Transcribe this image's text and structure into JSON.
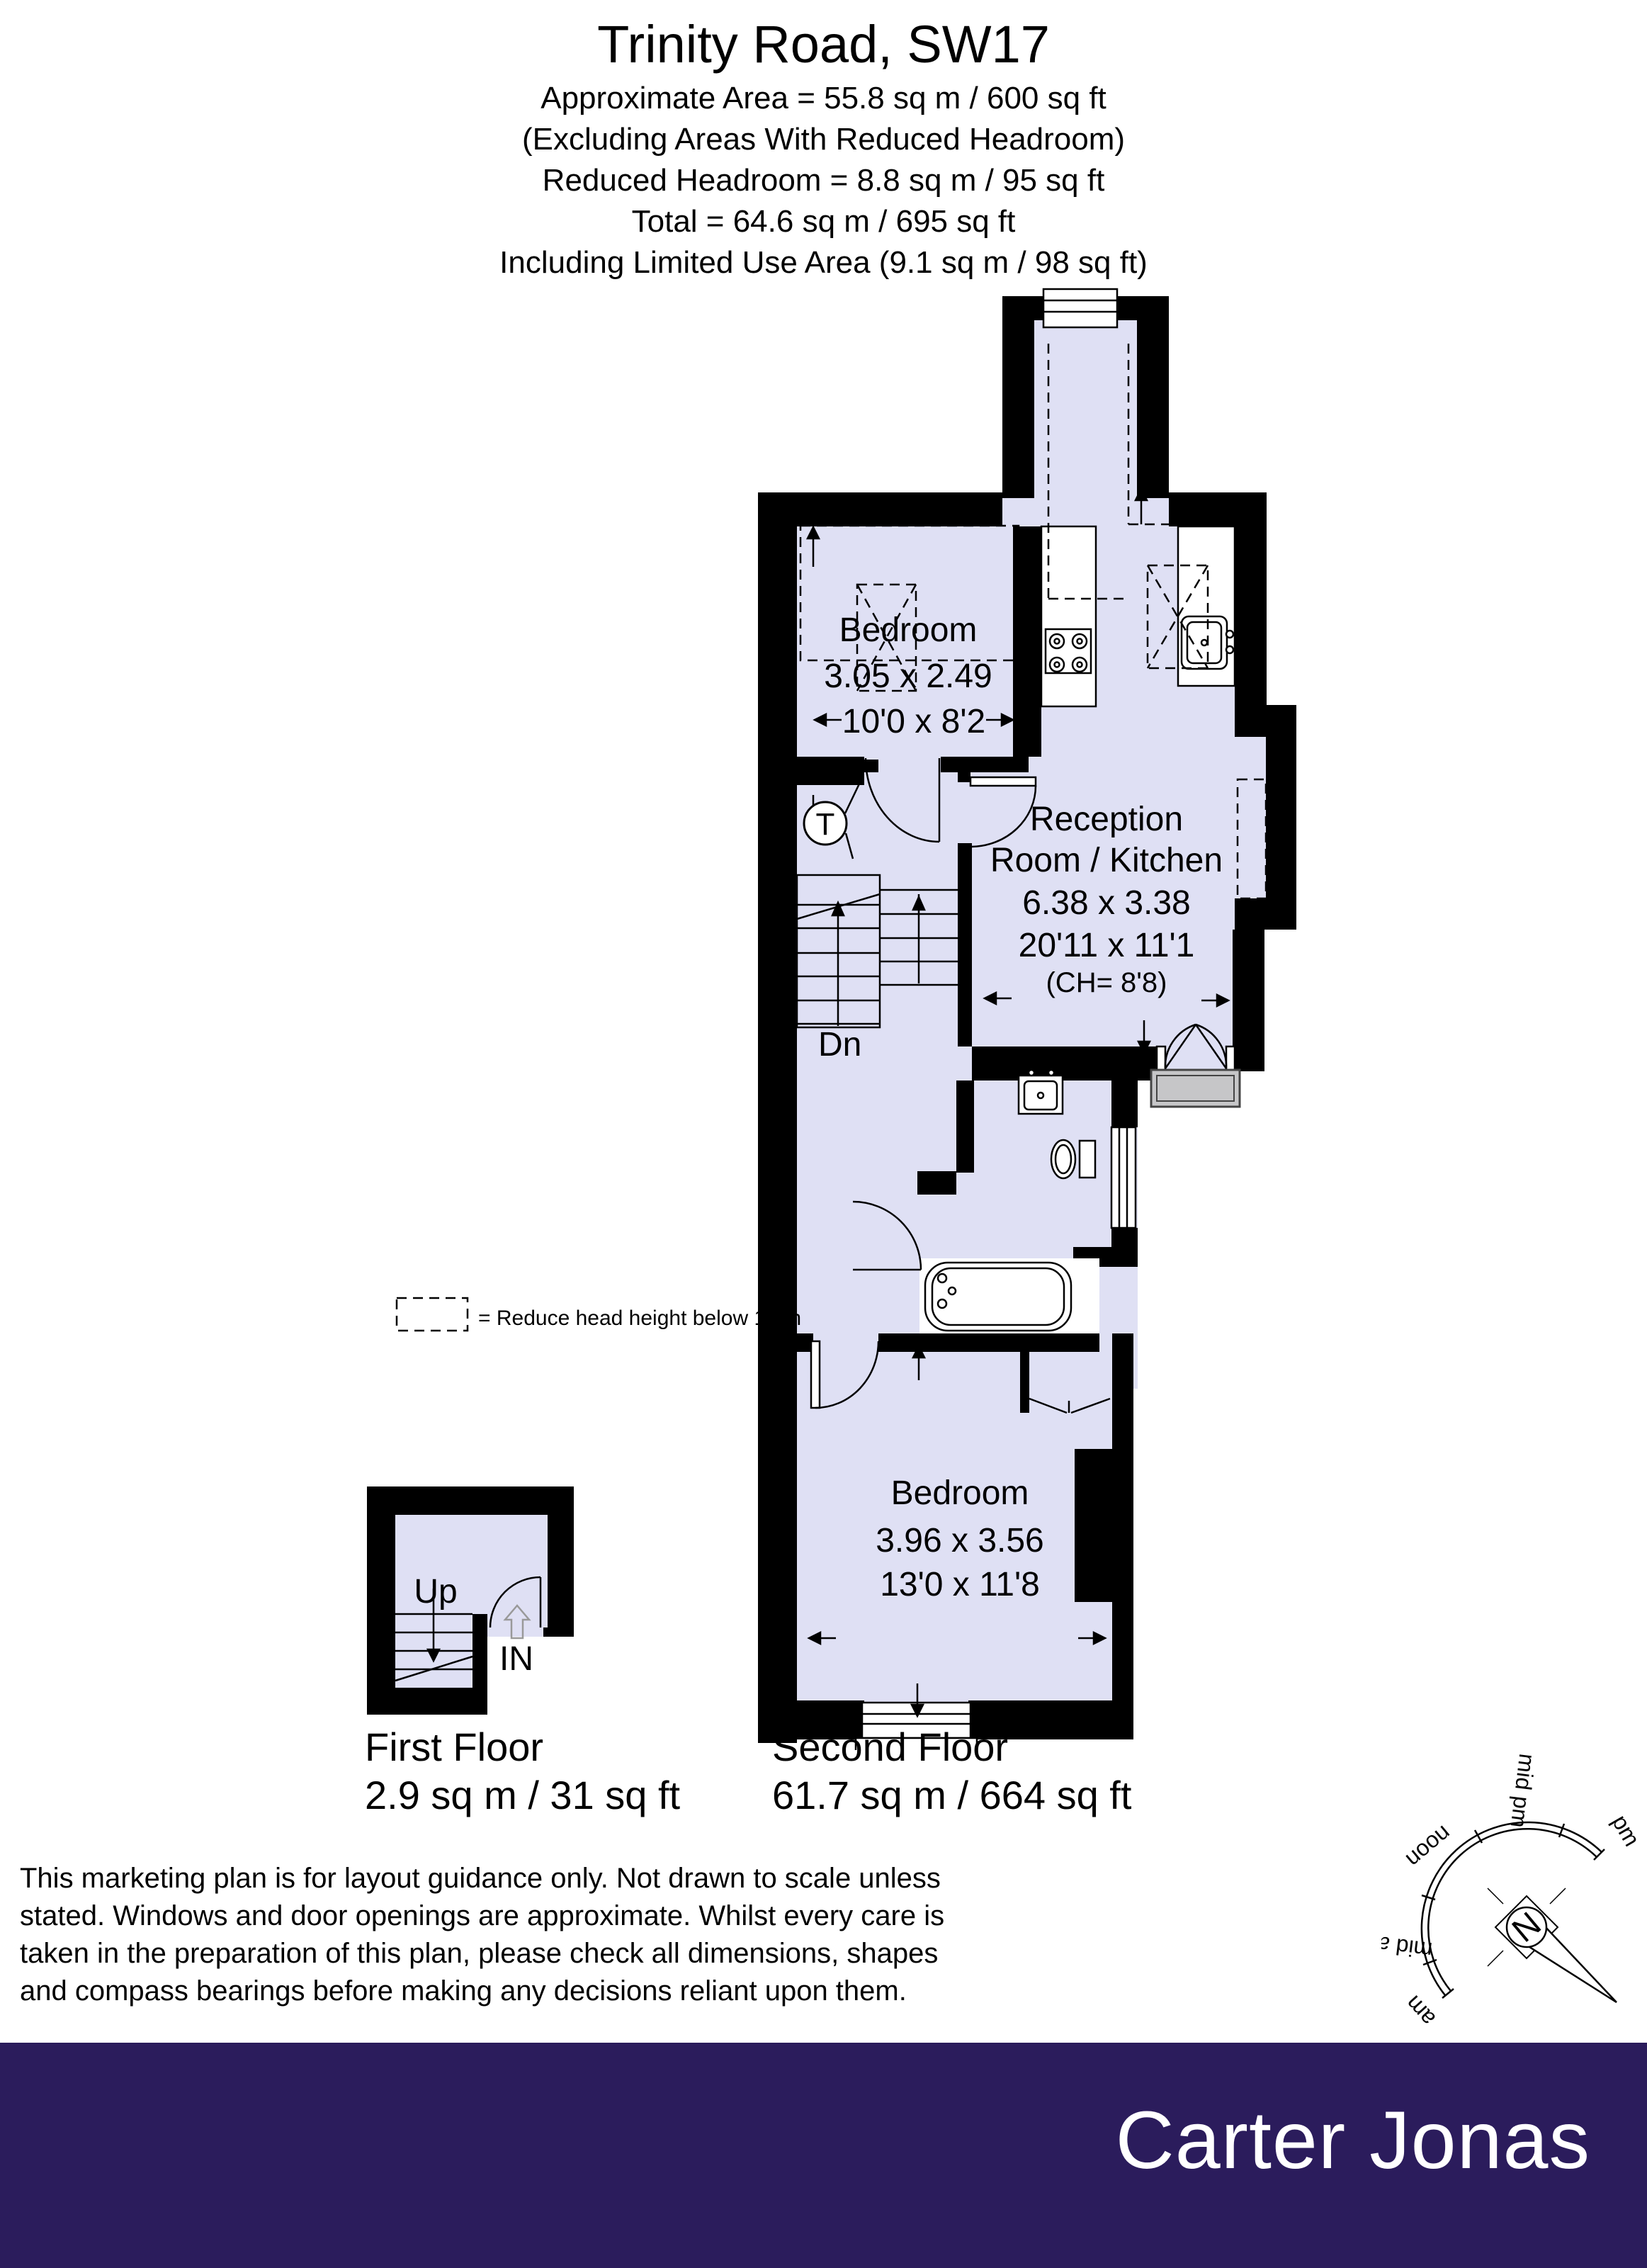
{
  "header": {
    "title": "Trinity Road, SW17",
    "lines": [
      "Approximate Area  = 55.8 sq m / 600 sq ft",
      "(Excluding Areas With Reduced Headroom)",
      "Reduced Headroom = 8.8 sq m / 95 sq ft",
      "Total = 64.6 sq m / 695 sq ft",
      "Including Limited Use Area (9.1 sq m / 98 sq ft)"
    ]
  },
  "plan": {
    "second_floor": {
      "bedroom_top": {
        "name": "Bedroom",
        "metric": "3.05 x 2.49",
        "imperial": "10'0 x 8'2"
      },
      "reception": {
        "line1": "Reception",
        "line2": "Room / Kitchen",
        "metric": "6.38 x 3.38",
        "imperial": "20'11 x 11'1",
        "ceiling": "(CH= 8'8)"
      },
      "bedroom_bottom": {
        "name": "Bedroom",
        "metric": "3.96 x 3.56",
        "imperial": "13'0 x 11'8"
      },
      "stairs_down_label": "Dn",
      "tank_label": "T"
    },
    "first_floor": {
      "stairs_up_label": "Up",
      "entrance_label": "IN"
    }
  },
  "legend": {
    "text": "= Reduce head height below 1.5m"
  },
  "floors": [
    {
      "label": "First Floor",
      "area": "2.9 sq m / 31 sq ft"
    },
    {
      "label": "Second Floor",
      "area": "61.7 sq m / 664 sq ft"
    }
  ],
  "disclaimer": {
    "lines": [
      "This marketing plan is for layout guidance only. Not drawn to scale unless",
      "stated. Windows and door openings are approximate. Whilst every care is",
      "taken in the preparation of this plan, please check all dimensions, shapes",
      "and compass bearings before making any decisions reliant upon them."
    ]
  },
  "compass": {
    "labels": [
      "am",
      "mid am",
      "noon",
      "mid pm",
      "pm"
    ],
    "north": "N"
  },
  "footer": {
    "brand": "Carter Jonas",
    "background": "#2b1c5c"
  },
  "colors": {
    "room_fill": "#dfe0f4",
    "wall": "#000000",
    "balcony": "#c6c6c8",
    "accent": "#2b1c5c"
  }
}
